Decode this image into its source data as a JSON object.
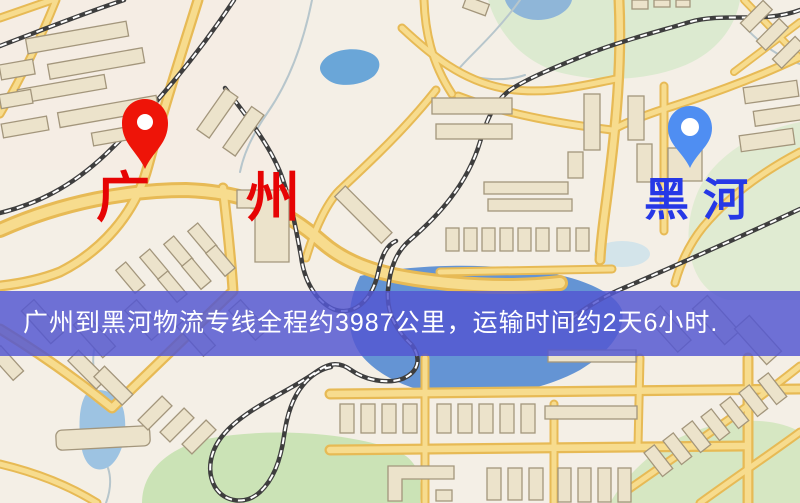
{
  "markers": {
    "origin": {
      "label": "广州",
      "pin_color": "#ee1408",
      "label_color": "#e60404"
    },
    "destination": {
      "label": "黑河",
      "pin_color": "#4f8ef2",
      "label_color": "#2638e6"
    }
  },
  "banner": {
    "text": "广州到黑河物流专线全程约3987公里，运输时间约2天6小时.",
    "background": "#5457d2",
    "text_color": "#ffffff"
  },
  "palette": {
    "map_background": "#f4efe6",
    "road_fill": "#f7dc8e",
    "road_border": "#e7ba55",
    "building_fill": "#ece3cb",
    "building_stroke": "#a3967c",
    "water": "#68a4d6",
    "park": "#d9e8c6",
    "railway": "#3e3e3e"
  }
}
